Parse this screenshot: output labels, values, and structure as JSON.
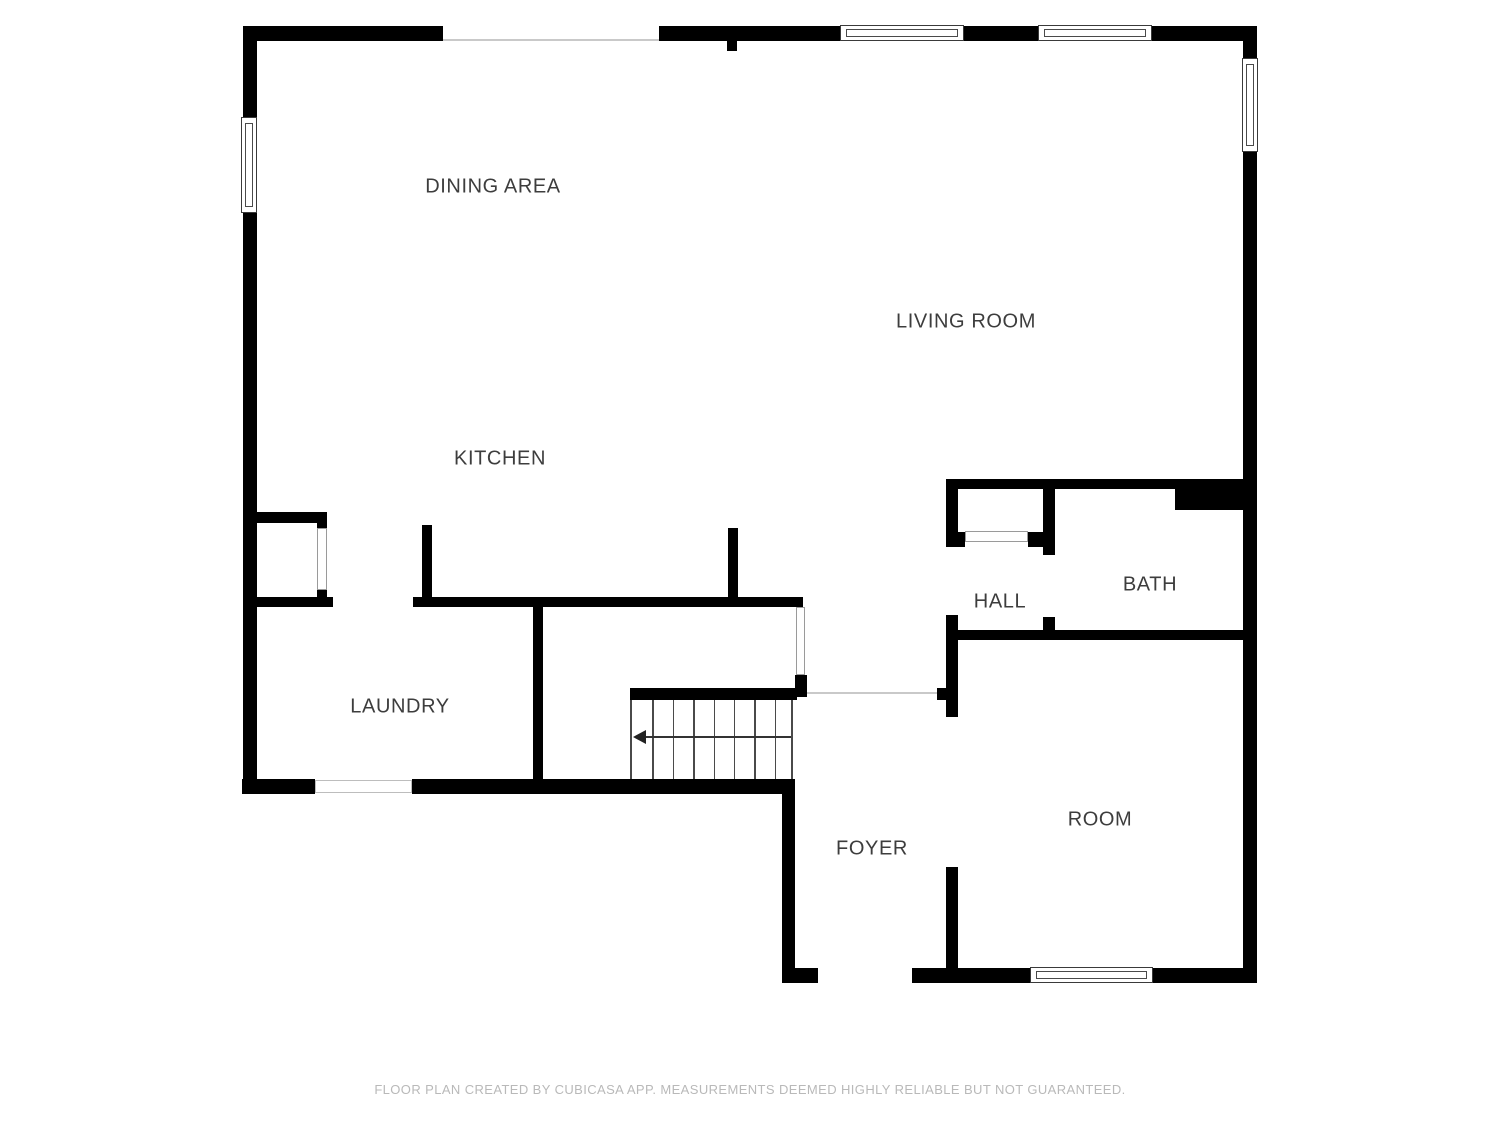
{
  "canvas": {
    "width": 1500,
    "height": 1125
  },
  "colors": {
    "background": "#ffffff",
    "wall": "#000000",
    "label_text": "#3d3d3d",
    "footer_text": "#b9b9b9",
    "thin_boundary_line": "#c9c9c9",
    "door_outline": "#9a9a9a",
    "stair_line": "#4a4a4a"
  },
  "footer": {
    "text": "FLOOR PLAN CREATED BY CUBICASA APP. MEASUREMENTS DEEMED HIGHLY RELIABLE BUT NOT GUARANTEED.",
    "y": 1082
  },
  "rooms": [
    {
      "id": "dining-area",
      "label": "DINING AREA",
      "cx": 493,
      "cy": 187
    },
    {
      "id": "living-room",
      "label": "LIVING ROOM",
      "cx": 966,
      "cy": 322
    },
    {
      "id": "kitchen",
      "label": "KITCHEN",
      "cx": 500,
      "cy": 459
    },
    {
      "id": "hall",
      "label": "HALL",
      "cx": 1000,
      "cy": 602
    },
    {
      "id": "bath",
      "label": "BATH",
      "cx": 1150,
      "cy": 585
    },
    {
      "id": "laundry",
      "label": "LAUNDRY",
      "cx": 400,
      "cy": 707
    },
    {
      "id": "foyer",
      "label": "FOYER",
      "cx": 872,
      "cy": 849
    },
    {
      "id": "room",
      "label": "ROOM",
      "cx": 1100,
      "cy": 820
    }
  ],
  "walls": [
    {
      "name": "wall-top-left",
      "x": 243,
      "y": 26,
      "w": 200,
      "h": 15
    },
    {
      "name": "wall-top-mid",
      "x": 659,
      "y": 26,
      "w": 181,
      "h": 15
    },
    {
      "name": "wall-top-between-windows",
      "x": 964,
      "y": 26,
      "w": 74,
      "h": 15
    },
    {
      "name": "wall-top-right",
      "x": 1152,
      "y": 26,
      "w": 105,
      "h": 15
    },
    {
      "name": "wall-top-stub",
      "x": 727,
      "y": 41,
      "w": 10,
      "h": 10
    },
    {
      "name": "wall-left-upper",
      "x": 243,
      "y": 26,
      "w": 14,
      "h": 91
    },
    {
      "name": "wall-left-main",
      "x": 243,
      "y": 213,
      "w": 14,
      "h": 566
    },
    {
      "name": "wall-right-upper",
      "x": 1243,
      "y": 41,
      "w": 14,
      "h": 17
    },
    {
      "name": "wall-right-main",
      "x": 1243,
      "y": 152,
      "w": 14,
      "h": 831
    },
    {
      "name": "wall-bottom-laundry",
      "x": 242,
      "y": 779,
      "w": 73,
      "h": 15
    },
    {
      "name": "wall-bottom-stairs",
      "x": 412,
      "y": 779,
      "w": 383,
      "h": 15
    },
    {
      "name": "wall-foyer-left",
      "x": 782,
      "y": 794,
      "w": 13,
      "h": 189
    },
    {
      "name": "wall-foyer-door-jamb",
      "x": 782,
      "y": 968,
      "w": 36,
      "h": 15
    },
    {
      "name": "wall-bottom-room-left",
      "x": 912,
      "y": 968,
      "w": 118,
      "h": 15
    },
    {
      "name": "wall-bottom-room-right",
      "x": 1153,
      "y": 968,
      "w": 104,
      "h": 15
    },
    {
      "name": "wall-kitchen-divider",
      "x": 413,
      "y": 597,
      "w": 390,
      "h": 10
    },
    {
      "name": "wall-kitchen-stub-left",
      "x": 422,
      "y": 525,
      "w": 10,
      "h": 72
    },
    {
      "name": "wall-kitchen-stub-right",
      "x": 728,
      "y": 528,
      "w": 10,
      "h": 69
    },
    {
      "name": "wall-closet-top",
      "x": 255,
      "y": 512,
      "w": 72,
      "h": 11
    },
    {
      "name": "wall-closet-jamb-top",
      "x": 317,
      "y": 512,
      "w": 10,
      "h": 16
    },
    {
      "name": "wall-closet-jamb-bottom",
      "x": 317,
      "y": 590,
      "w": 10,
      "h": 17
    },
    {
      "name": "wall-laundry-top",
      "x": 255,
      "y": 597,
      "w": 78,
      "h": 10
    },
    {
      "name": "wall-laundry-divider",
      "x": 533,
      "y": 597,
      "w": 10,
      "h": 197
    },
    {
      "name": "wall-stairs-top",
      "x": 630,
      "y": 688,
      "w": 167,
      "h": 12
    },
    {
      "name": "wall-stairs-jamb",
      "x": 795,
      "y": 675,
      "w": 12,
      "h": 22
    },
    {
      "name": "wall-opening-jamb-right",
      "x": 937,
      "y": 688,
      "w": 9,
      "h": 12
    },
    {
      "name": "wall-hall-top",
      "x": 946,
      "y": 479,
      "w": 299,
      "h": 10
    },
    {
      "name": "wall-bath-notch",
      "x": 1175,
      "y": 489,
      "w": 68,
      "h": 21
    },
    {
      "name": "wall-hall-left-upper",
      "x": 946,
      "y": 479,
      "w": 12,
      "h": 68
    },
    {
      "name": "wall-hall-left-mid",
      "x": 946,
      "y": 615,
      "w": 12,
      "h": 102
    },
    {
      "name": "wall-hall-left-lower",
      "x": 946,
      "y": 867,
      "w": 12,
      "h": 101
    },
    {
      "name": "wall-hall-closet-jamb-left",
      "x": 958,
      "y": 532,
      "w": 7,
      "h": 15
    },
    {
      "name": "wall-hall-closet-jamb-right",
      "x": 1028,
      "y": 532,
      "w": 15,
      "h": 15
    },
    {
      "name": "wall-hall-divider-upper",
      "x": 1043,
      "y": 479,
      "w": 12,
      "h": 76
    },
    {
      "name": "wall-hall-divider-lower",
      "x": 1043,
      "y": 617,
      "w": 12,
      "h": 23
    },
    {
      "name": "wall-hall-bath-bottom",
      "x": 946,
      "y": 630,
      "w": 297,
      "h": 10
    }
  ],
  "windows": [
    {
      "name": "window-left-wall",
      "x": 241,
      "y": 117,
      "w": 16,
      "h": 96
    },
    {
      "name": "window-top-wall-1",
      "x": 840,
      "y": 25,
      "w": 124,
      "h": 16
    },
    {
      "name": "window-top-wall-2",
      "x": 1038,
      "y": 25,
      "w": 114,
      "h": 16
    },
    {
      "name": "window-right-wall",
      "x": 1242,
      "y": 58,
      "w": 16,
      "h": 94
    },
    {
      "name": "window-room-bottom",
      "x": 1030,
      "y": 967,
      "w": 123,
      "h": 16
    }
  ],
  "openings": [
    {
      "name": "opening-laundry-bottom",
      "x": 315,
      "y": 780,
      "w": 97,
      "h": 13
    }
  ],
  "doors": [
    {
      "name": "door-laundry-closet",
      "x": 317,
      "y": 528,
      "w": 10,
      "h": 62
    },
    {
      "name": "door-stair-landing",
      "x": 796,
      "y": 607,
      "w": 9,
      "h": 68
    },
    {
      "name": "door-hall-closet",
      "x": 965,
      "y": 531,
      "w": 63,
      "h": 11
    }
  ],
  "boundary_lines": [
    {
      "name": "boundary-top-gap",
      "x": 443,
      "y": 39,
      "w": 216,
      "h": 2
    },
    {
      "name": "boundary-foyer-opening",
      "x": 807,
      "y": 692,
      "w": 130,
      "h": 2
    }
  ],
  "stairs": {
    "x": 630,
    "y": 700,
    "w": 163,
    "h": 79,
    "treads": 8,
    "arrow_y_offset": 36,
    "arrow_direction": "left"
  }
}
